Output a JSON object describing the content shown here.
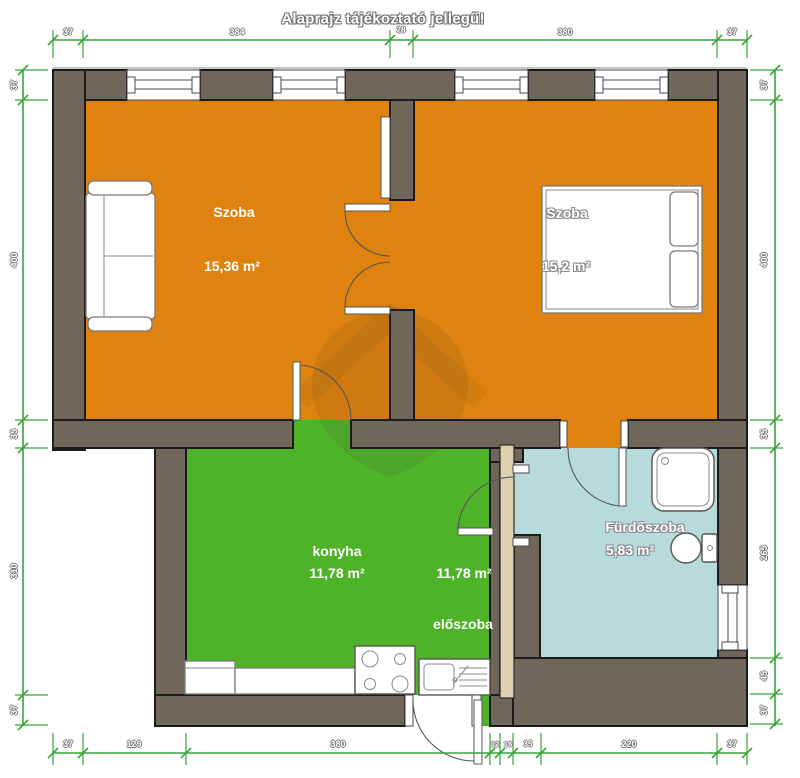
{
  "title": "Alaprajz tájékoztató jellegű!",
  "rooms": [
    {
      "name": "Szoba",
      "area": "15,36 m²"
    },
    {
      "name": "Szoba",
      "area": "15,2 m²"
    },
    {
      "name": "konyha",
      "area": "11,78 m²"
    },
    {
      "name": "előszoba",
      "area": "11,78 m²"
    },
    {
      "name": "Fürdőszoba",
      "area": "5,83 m²"
    }
  ],
  "dimensions": {
    "top": [
      "37",
      "384",
      "28",
      "380",
      "37"
    ],
    "bottom": [
      "37",
      "129",
      "380",
      "12",
      "16",
      "35",
      "220",
      "37"
    ],
    "left": [
      "37",
      "400",
      "35",
      "310",
      "37"
    ],
    "right": [
      "37",
      "400",
      "35",
      "265",
      "45",
      "37"
    ]
  },
  "colors": {
    "orange": "#E0820F",
    "green": "#4FB32A",
    "teal": "#B7DBDA",
    "wall": "#6F675A",
    "beige": "#DCD2B2",
    "dim": "#3BA33B"
  }
}
